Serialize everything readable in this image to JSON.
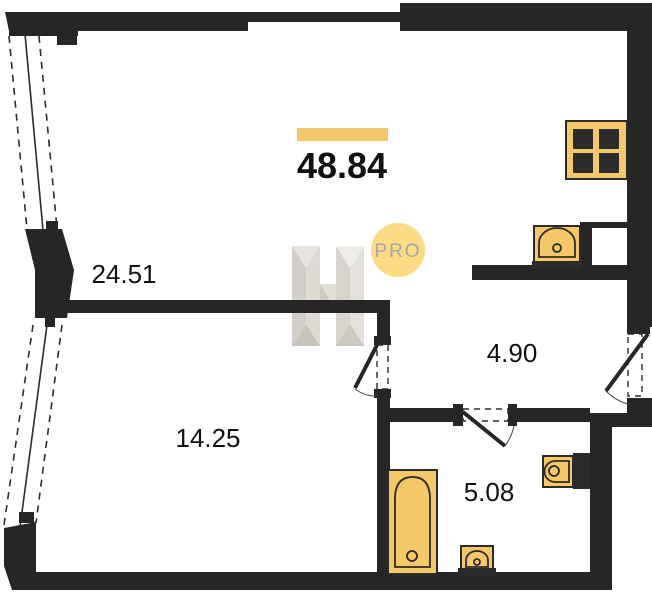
{
  "plan": {
    "total_area": "48.84",
    "watermark": {
      "logo_letter": "H",
      "badge": "PRO"
    },
    "rooms": [
      {
        "id": "living",
        "area": "24.51"
      },
      {
        "id": "bedroom",
        "area": "14.25"
      },
      {
        "id": "hallway",
        "area": "4.90"
      },
      {
        "id": "bathroom",
        "area": "5.08"
      }
    ],
    "colors": {
      "wall": "#262626",
      "fixture_fill": "#F4C869",
      "fixture_stroke": "#2b2b2b",
      "accent_bar": "#F3C76B",
      "pro_badge_fill": "#FBDC85",
      "pro_badge_text": "#A6A6A6"
    }
  }
}
